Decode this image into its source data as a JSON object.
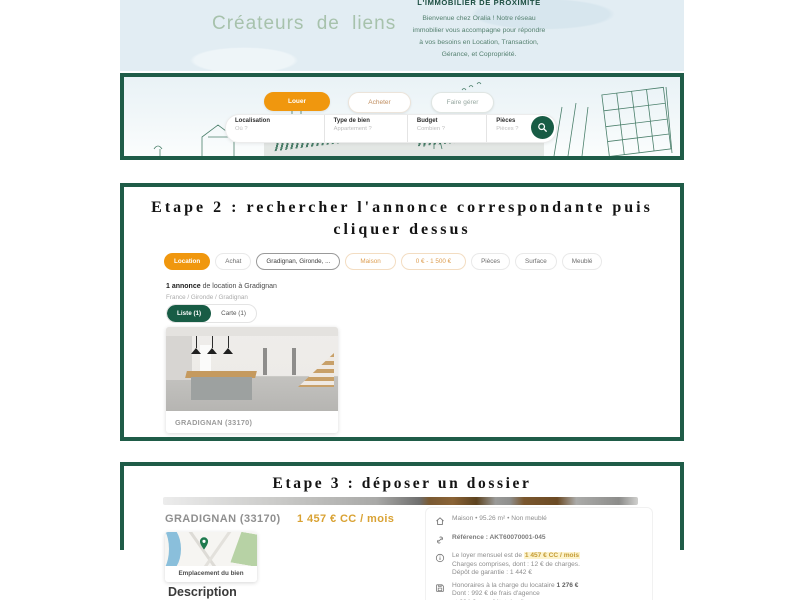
{
  "colors": {
    "brand_green": "#1f5c48",
    "accent_orange": "#f0970e",
    "price_gold": "#d9a233",
    "sky_blue": "#e2edf3"
  },
  "hero": {
    "tagline": "Créateurs de liens",
    "intro_title": "L'IMMOBILIER DE PROXIMITÉ",
    "intro_lines": {
      "0": "Bienvenue chez Oralia ! Notre réseau",
      "1": "immobilier vous accompagne pour répondre",
      "2": "à vos besoins en Location, Transaction,",
      "3": "Gérance, et Copropriété."
    },
    "tabs": {
      "0": {
        "label": "Louer",
        "active": true
      },
      "1": {
        "label": "Acheter",
        "active": false
      },
      "2": {
        "label": "Faire gérer",
        "active": false
      }
    },
    "search_fields": {
      "0": {
        "label": "Localisation",
        "placeholder": "Où ?"
      },
      "1": {
        "label": "Type de bien",
        "placeholder": "Appartement ?"
      },
      "2": {
        "label": "Budget",
        "placeholder": "Combien ?"
      },
      "3": {
        "label": "Pièces",
        "placeholder": "Pièces ?"
      }
    },
    "search_button_icon": "magnifier"
  },
  "step2": {
    "title_line1": "Etape 2 : rechercher l'annonce correspondante puis",
    "title_line2": "cliquer dessus",
    "filter_pills": {
      "0": {
        "label": "Location"
      },
      "1": {
        "label": "Achat"
      },
      "2": {
        "label": "Gradignan, Gironde, ..."
      },
      "3": {
        "label": "Maison"
      },
      "4": {
        "label": "0 € - 1 500 €"
      },
      "5": {
        "label": "Pièces"
      },
      "6": {
        "label": "Surface"
      },
      "7": {
        "label": "Meublé"
      }
    },
    "results_bold": "1 annonce",
    "results_rest": " de location à Gradignan",
    "breadcrumb": "France / Gironde / Gradignan",
    "view_toggle": {
      "liste": "Liste (1)",
      "carte": "Carte (1)"
    },
    "card_title": "GRADIGNAN (33170)"
  },
  "step3": {
    "title": "Etape 3 : déposer un dossier",
    "city": "GRADIGNAN (33170)",
    "price": "1 457 € CC / mois",
    "map_label": "Emplacement du bien",
    "description_heading": "Description",
    "details": {
      "type_line": "Maison • 95.26 m² • Non meublé",
      "reference_line": "Référence : AKT60070001-045",
      "rent_pre": "Le loyer mensuel est de ",
      "rent_highlight": "1 457 € CC / mois",
      "rent_line2": "Charges comprises, dont : 12 € de charges.",
      "rent_line3": "Dépôt de garantie : 1 442 €",
      "fees_pre": "Honoraires à la charge du locataire ",
      "fees_amount": "1 276 €",
      "fees_line2": "Dont : 992 € de frais d'agence",
      "fees_line3": "et 284 € pour l'état des lieux"
    }
  }
}
